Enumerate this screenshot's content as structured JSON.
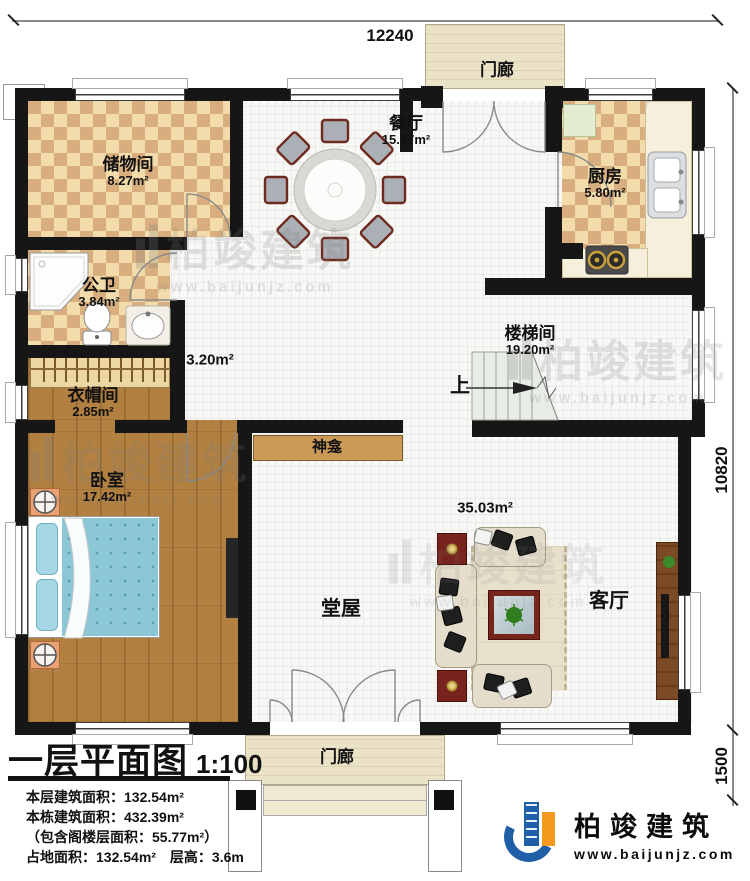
{
  "title": {
    "name": "一层平面图",
    "scale": "1:100"
  },
  "stats": {
    "line1": "本层建筑面积：132.54m²",
    "line2": "本栋建筑面积：432.39m²",
    "line3": "（包含阁楼层面积：55.77m²）",
    "line4": "占地面积：132.54m²　层高：3.6m"
  },
  "brand": {
    "name": "柏竣建筑",
    "url": "www.baijunjz.com"
  },
  "dimensions": {
    "top": "12240",
    "right": "10820",
    "porch": "1500"
  },
  "rooms": {
    "storage": {
      "name": "储物间",
      "area": "8.27m²"
    },
    "dining": {
      "name": "餐厅",
      "area": "15.27m²"
    },
    "kitchen": {
      "name": "厨房",
      "area": "5.80m²"
    },
    "bathroom": {
      "name": "公卫",
      "area": "3.84m²"
    },
    "cloakroom": {
      "name": "衣帽间",
      "area": "2.85m²"
    },
    "bedroom": {
      "name": "卧室",
      "area": "17.42m²"
    },
    "stairwell": {
      "name": "楼梯间",
      "area": "19.20m²"
    },
    "hall": {
      "name": "堂屋",
      "area": "35.03m²"
    },
    "living": {
      "name": "客厅"
    },
    "hallway": {
      "area": "3.20m²"
    },
    "shrine": {
      "name": "神龛"
    },
    "porch_top": {
      "name": "门廊"
    },
    "porch_bottom": {
      "name": "门廊"
    }
  },
  "annotations": {
    "up": "上"
  }
}
